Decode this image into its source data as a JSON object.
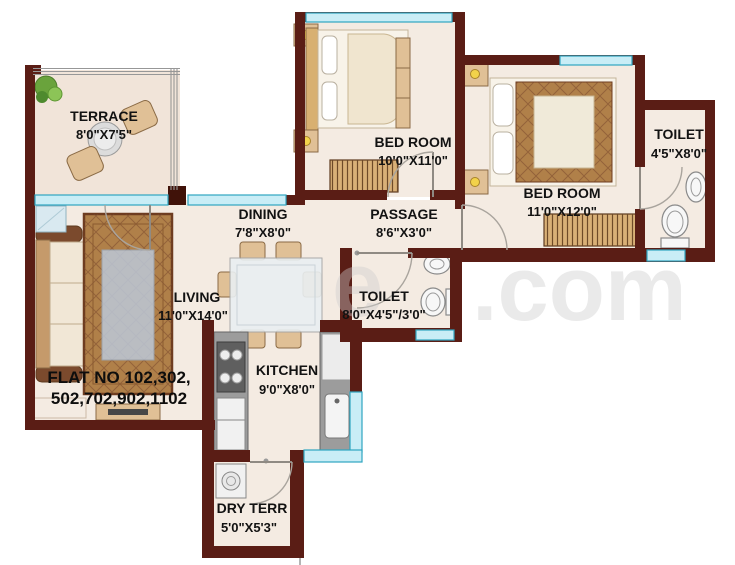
{
  "plan": {
    "title": "2 BHK Flat Floor Plan",
    "flat_no": {
      "line1": "FLAT NO 102,302,",
      "line2": "502,702,902,1102"
    },
    "watermark": {
      "left": "e",
      "right": ".com"
    },
    "rooms": [
      {
        "id": "terrace",
        "name": "TERRACE",
        "dims": "8'0\"X7'5\""
      },
      {
        "id": "bedroom-1",
        "name": "BED ROOM",
        "dims": "10'0\"X11'0\""
      },
      {
        "id": "bedroom-2",
        "name": "BED ROOM",
        "dims": "11'0\"X12'0\""
      },
      {
        "id": "toilet-right",
        "name": "TOILET",
        "dims": "4'5\"X8'0\""
      },
      {
        "id": "dining",
        "name": "DINING",
        "dims": "7'8\"X8'0\""
      },
      {
        "id": "passage",
        "name": "PASSAGE",
        "dims": "8'6\"X3'0\""
      },
      {
        "id": "toilet-middle",
        "name": "TOILET",
        "dims": "8'0\"X4'5\"/3'0\""
      },
      {
        "id": "living",
        "name": "LIVING",
        "dims": "11'0\"X14'0\""
      },
      {
        "id": "kitchen",
        "name": "KITCHEN",
        "dims": "9'0\"X8'0\""
      },
      {
        "id": "dry-terrace",
        "name": "DRY TERR",
        "dims": "5'0\"X5'3\""
      }
    ],
    "colors": {
      "wall": "#5a1d15",
      "window": "#c9edf6",
      "window_border": "#2fa5c0",
      "floor": "#f4ebe2",
      "label_text": "#121212",
      "watermark": "#cdcdcd"
    }
  }
}
